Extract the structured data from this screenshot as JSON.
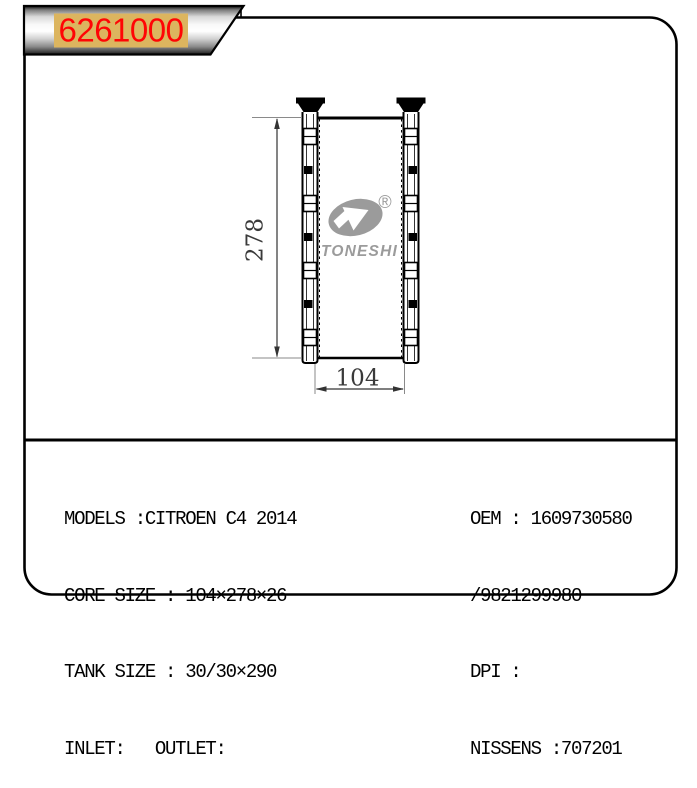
{
  "banner": {
    "part_number": "6261000",
    "text_color": "#ff0000",
    "highlight_color": "#dcb55f"
  },
  "drawing": {
    "height_label": "278",
    "width_label": "104",
    "watermark_brand": "TONESHI",
    "registered_mark": "®",
    "watermark_color": "#9b9b9b"
  },
  "specs": {
    "left": [
      "MODELS :CITROEN C4 2014",
      "CORE SIZE : 104×278×26",
      "TANK SIZE : 30/30×290",
      "INLET:   OUTLET:"
    ],
    "right": [
      "OEM : 1609730580",
      "/9821299980",
      "DPI :",
      "NISSENS :707201"
    ]
  }
}
